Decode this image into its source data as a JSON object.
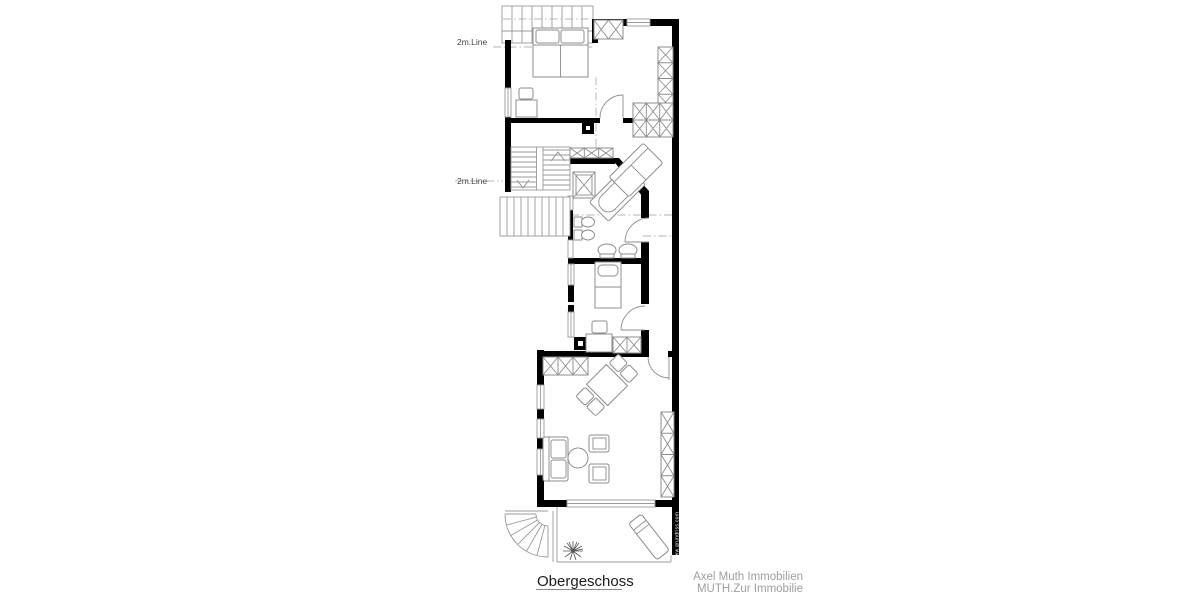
{
  "labels": {
    "roof_line_top": "2m.Line",
    "roof_line_mid": "2m.Line",
    "floor_title": "Obergeschoss",
    "branding_line1": "Axel Muth Immobilien",
    "branding_line2": "MUTH.Zur Immobilie",
    "watermark": "www.grundriss.com"
  },
  "colors": {
    "wall": "#000000",
    "thin_line": "#9a9a9a",
    "furniture_line": "#8c8c8c",
    "dash_line": "#b3b3b3",
    "title_text": "#1c1c1c",
    "branding_text": "#9e9e9e",
    "watermark_text": "#ffffff",
    "background": "#ffffff"
  }
}
